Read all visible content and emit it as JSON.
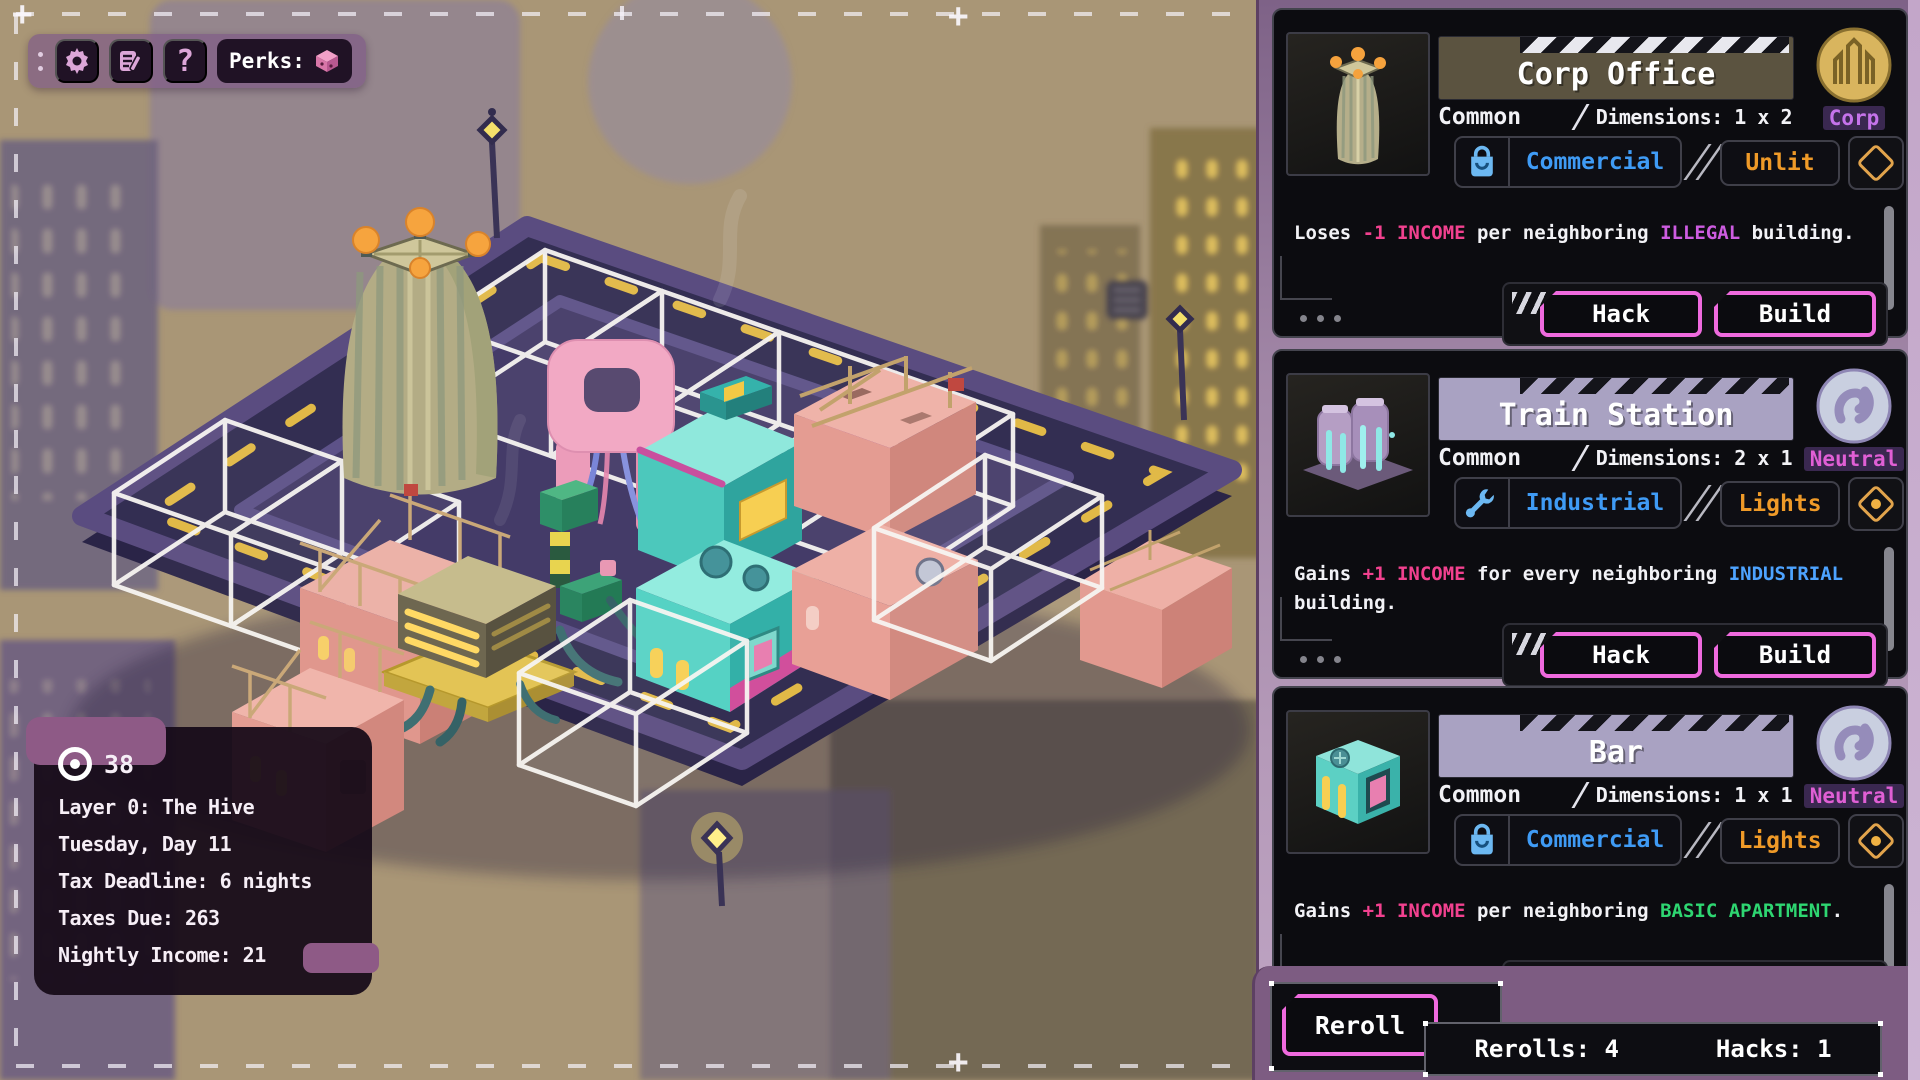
{
  "toolbar": {
    "perks_label": "Perks:",
    "help_glyph": "?",
    "icons": [
      "settings-gear",
      "notes",
      "help",
      "perks-cube"
    ]
  },
  "stats_panel": {
    "currency_amount": "38",
    "lines": [
      "Layer 0: The Hive",
      "Tuesday, Day 11",
      "Tax Deadline: 6 nights",
      "Taxes Due: 263",
      "Nightly Income: 21"
    ]
  },
  "cards": [
    {
      "title": "Corp Office",
      "rarity": "Common",
      "dimensions": "Dimensions: 1 x 2",
      "faction": "Corp",
      "category": "Commercial",
      "light": "Unlit",
      "hack_label": "Hack",
      "build_label": "Build",
      "description": [
        {
          "t": "Loses "
        },
        {
          "t": "-1 INCOME",
          "c": "#f2418f"
        },
        {
          "t": " per neighboring "
        },
        {
          "t": "ILLEGAL",
          "c": "#cd5ce0"
        },
        {
          "t": " building."
        }
      ]
    },
    {
      "title": "Train Station",
      "rarity": "Common",
      "dimensions": "Dimensions: 2 x 1",
      "faction": "Neutral",
      "category": "Industrial",
      "light": "Lights",
      "hack_label": "Hack",
      "build_label": "Build",
      "description": [
        {
          "t": "Gains "
        },
        {
          "t": "+1 INCOME",
          "c": "#f2418f"
        },
        {
          "t": " for every neighboring "
        },
        {
          "t": "INDUSTRIAL",
          "c": "#4da3ff"
        },
        {
          "t": " building."
        }
      ]
    },
    {
      "title": "Bar",
      "rarity": "Common",
      "dimensions": "Dimensions: 1 x 1",
      "faction": "Neutral",
      "category": "Commercial",
      "light": "Lights",
      "hack_label": "Hack",
      "build_label": "Build",
      "description": [
        {
          "t": "Gains "
        },
        {
          "t": "+1 INCOME",
          "c": "#f2418f"
        },
        {
          "t": " per neighboring "
        },
        {
          "t": "BASIC APARTMENT",
          "c": "#2ed671"
        },
        {
          "t": "."
        }
      ]
    }
  ],
  "footer": {
    "reroll_label": "Reroll",
    "rerolls": "Rerolls: 4",
    "hacks": "Hacks: 1"
  },
  "colors": {
    "accent_magenta": "#ee66e0",
    "income_pink": "#f2418f",
    "illegal_purple": "#cd5ce0",
    "industrial_blue": "#4da3ff",
    "basic_apartment_green": "#2ed671",
    "unlit_orange": "#ef9a28",
    "commercial_blue": "#3f9bf5",
    "corp_violet": "#c573ea",
    "neutral_magenta": "#e05fd5",
    "road_dash_yellow": "#f0c546",
    "title_olive": "#5b5340",
    "title_lavender": "#a9a2c2"
  }
}
